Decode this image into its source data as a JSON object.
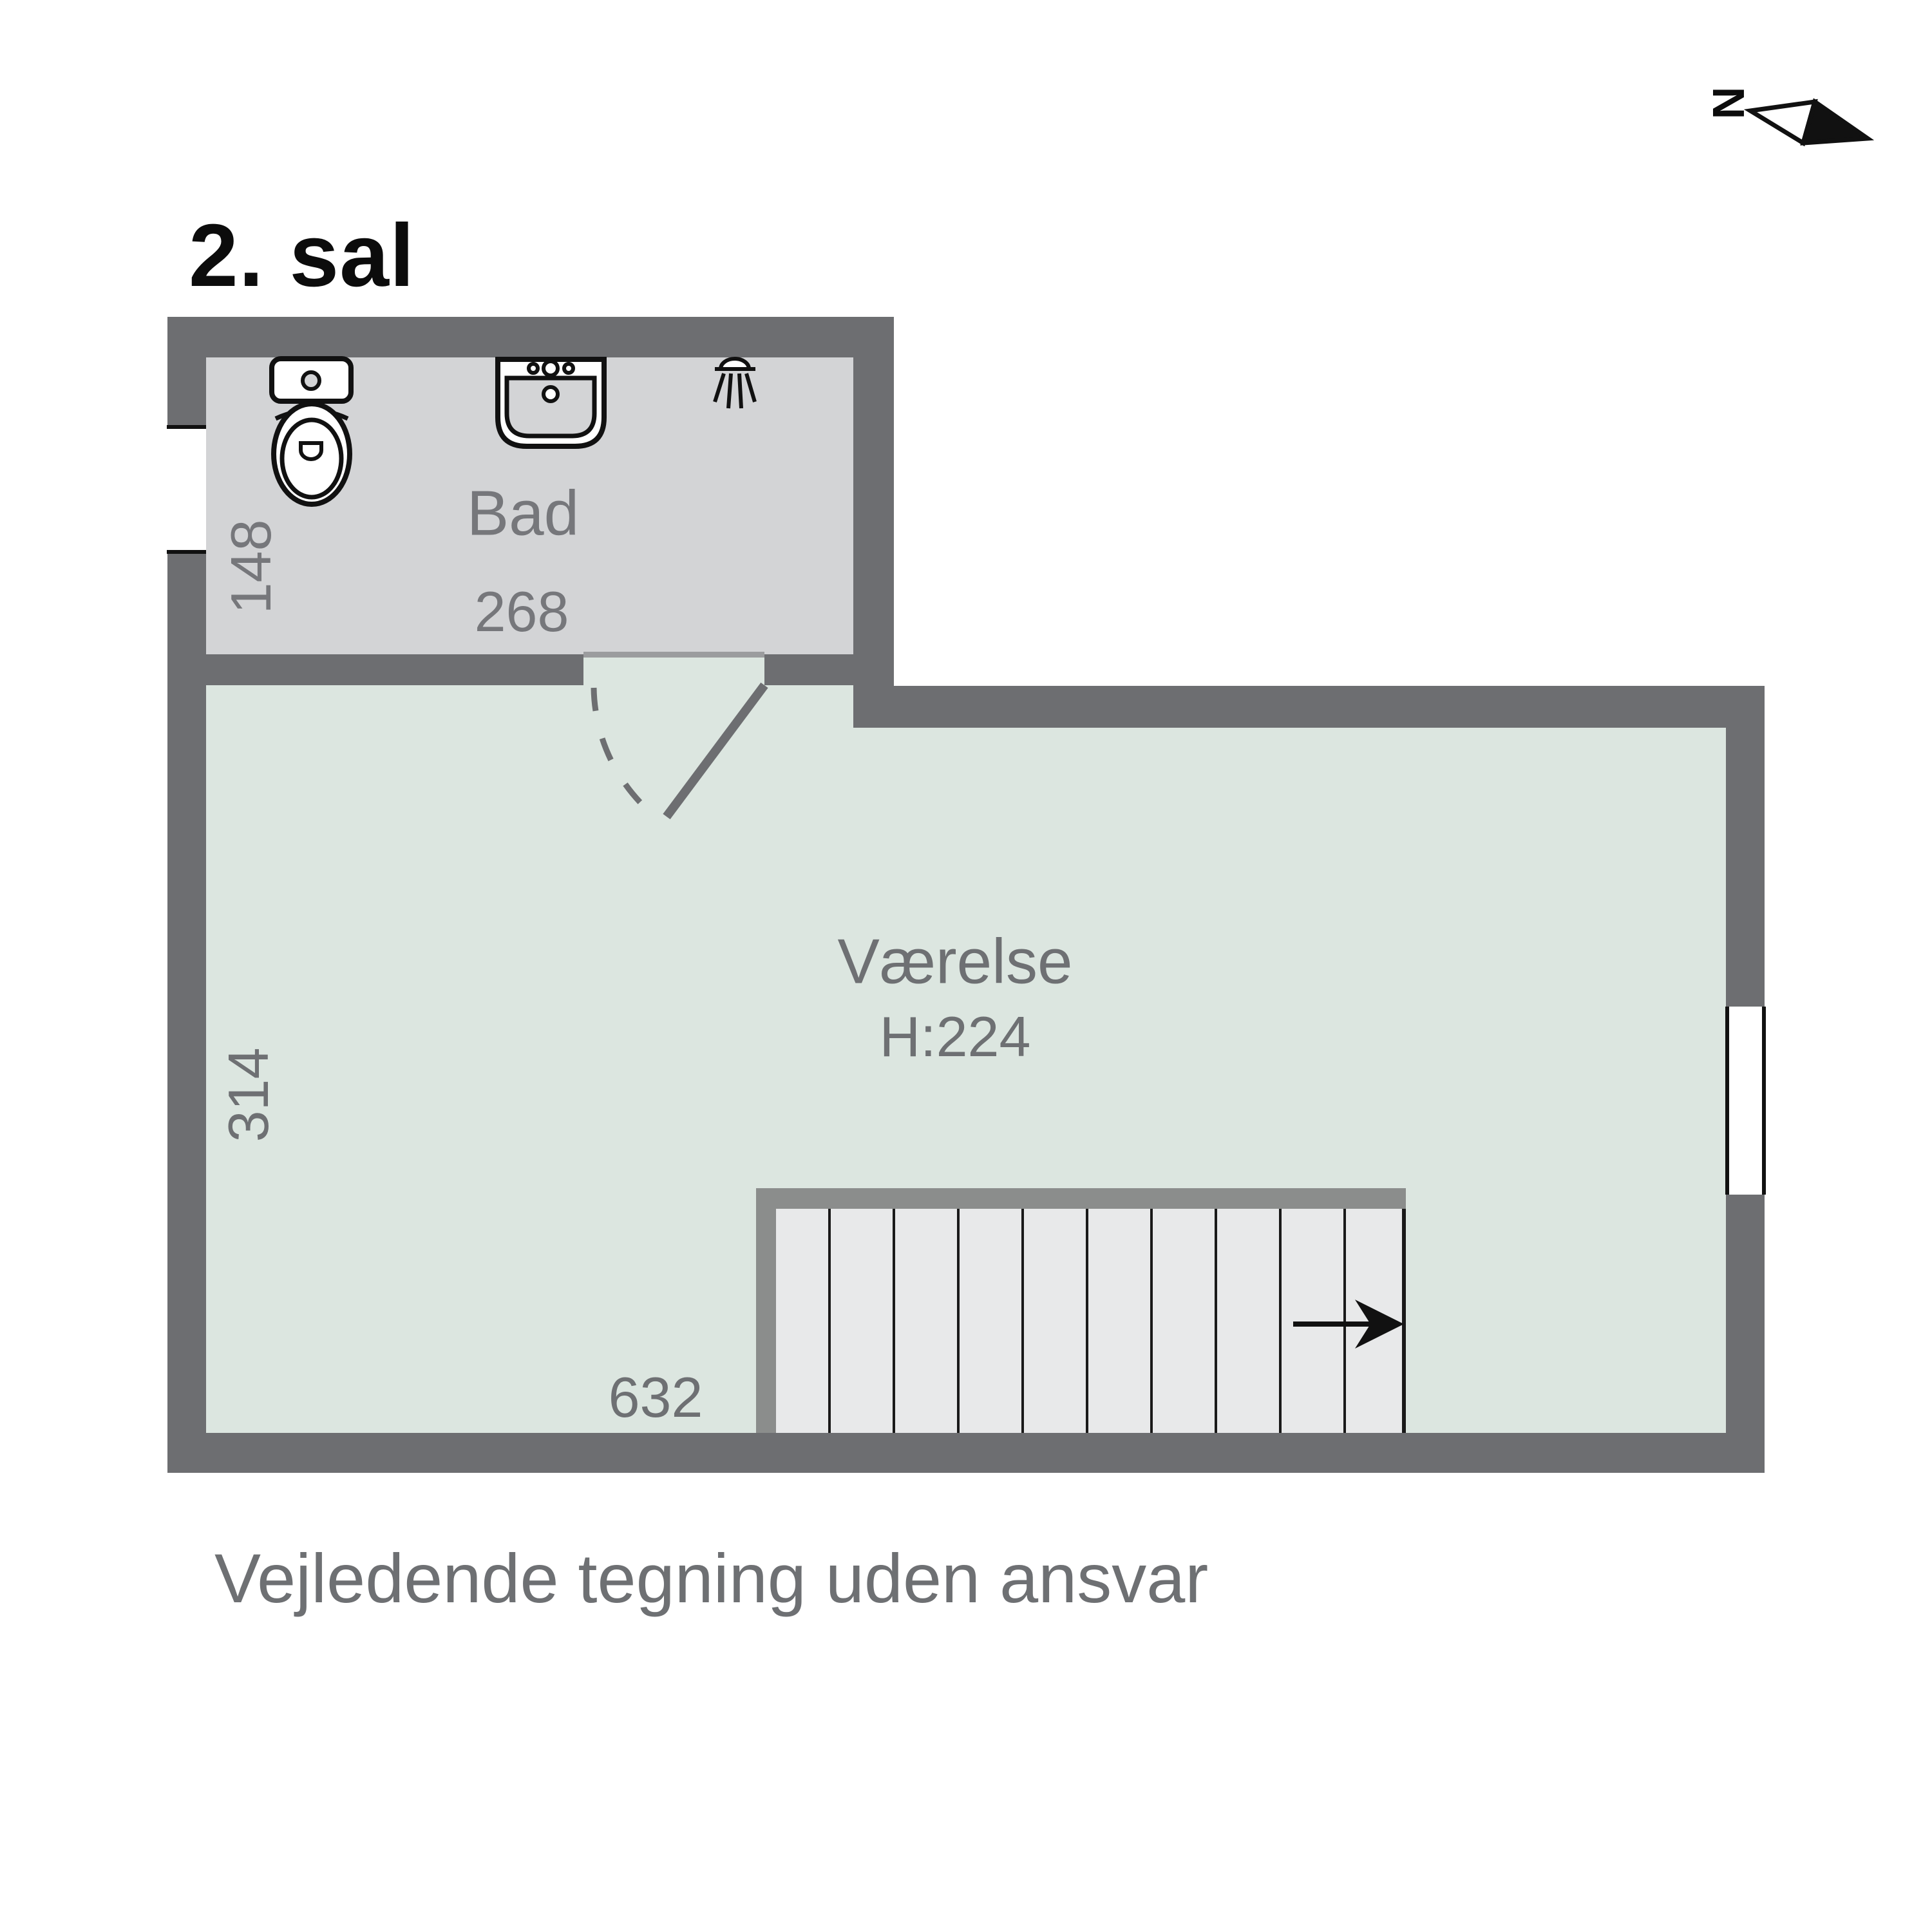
{
  "title": "2. sal",
  "north": {
    "label": "N"
  },
  "rooms": {
    "bathroom": {
      "name": "Bad",
      "width_label": "268",
      "depth_label": "148",
      "fixtures": [
        "toilet-icon",
        "sink-icon",
        "shower-icon"
      ]
    },
    "room": {
      "name": "Værelse",
      "ceiling_height_label": "H:224",
      "depth_label": "314",
      "width_label": "632"
    }
  },
  "footer": "Vejledende tegning uden ansvar",
  "colors": {
    "wall": "#6d6e71",
    "bathroom_floor": "#d3d4d6",
    "room_floor": "#dce6e0",
    "stairs_fill": "#e8e9ea",
    "stairs_frame": "#8b8d8c",
    "threshold": "#9b9c9e",
    "tread_line": "#1a1a1a",
    "label_text": "#6e7073",
    "title_text": "#0c0c0c"
  }
}
